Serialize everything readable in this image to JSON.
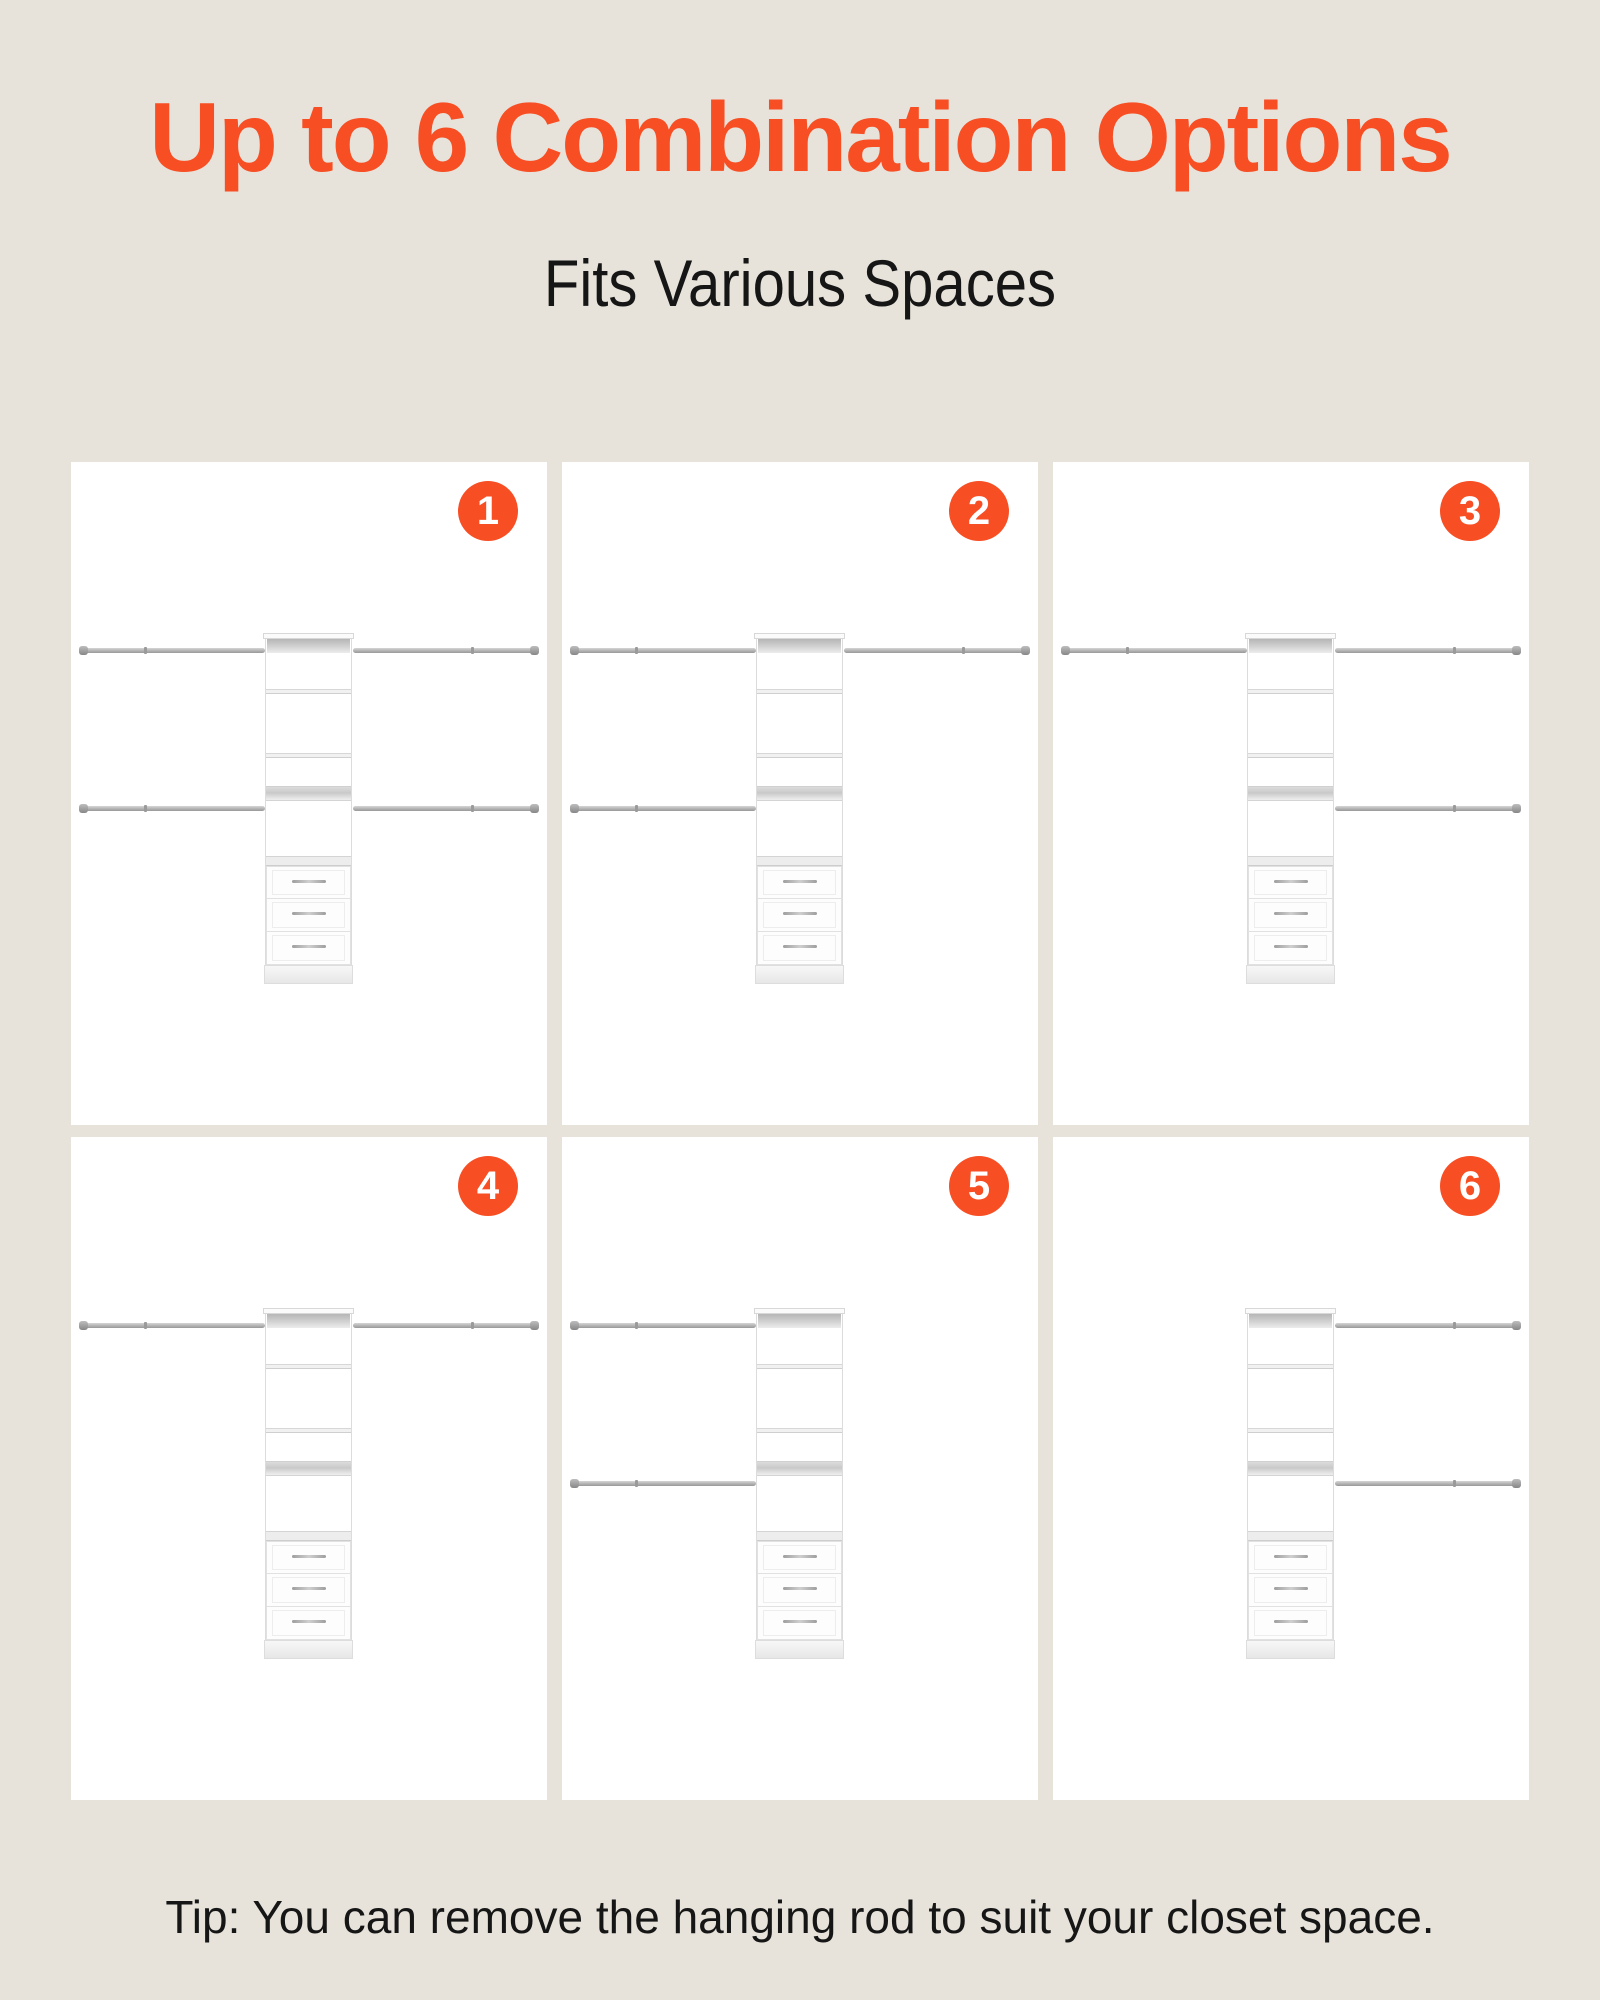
{
  "header": {
    "title": "Up to 6 Combination Options",
    "subtitle": "Fits Various Spaces"
  },
  "footer": {
    "tip": "Tip: You can remove the hanging rod to suit your closet space."
  },
  "colors": {
    "accent": "#F74E24",
    "background": "#E7E3DA",
    "card": "#FFFFFF",
    "text": "#161616"
  },
  "options": [
    {
      "number": "1",
      "rods": {
        "top_left": true,
        "top_right": true,
        "mid_left": true,
        "mid_right": true
      }
    },
    {
      "number": "2",
      "rods": {
        "top_left": true,
        "top_right": true,
        "mid_left": true,
        "mid_right": false
      }
    },
    {
      "number": "3",
      "rods": {
        "top_left": true,
        "top_right": true,
        "mid_left": false,
        "mid_right": true
      }
    },
    {
      "number": "4",
      "rods": {
        "top_left": true,
        "top_right": true,
        "mid_left": false,
        "mid_right": false
      }
    },
    {
      "number": "5",
      "rods": {
        "top_left": true,
        "top_right": false,
        "mid_left": true,
        "mid_right": false
      }
    },
    {
      "number": "6",
      "rods": {
        "top_left": false,
        "top_right": true,
        "mid_left": false,
        "mid_right": true
      }
    }
  ]
}
